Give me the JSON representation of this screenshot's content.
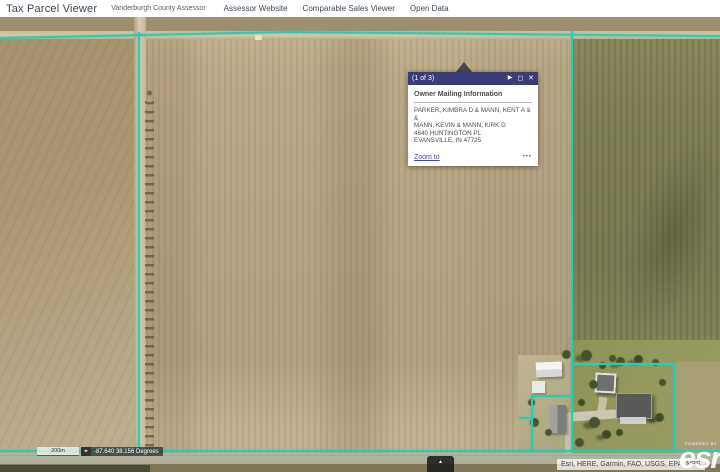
{
  "header": {
    "title": "Tax Parcel Viewer",
    "subtitle": "Vanderburgh County Assessor",
    "links": [
      "Assessor Website",
      "Comparable Sales Viewer",
      "Open Data"
    ]
  },
  "popup": {
    "pager": "(1 of 3)",
    "next_icon": "▶",
    "dock_icon": "◻",
    "close_icon": "✕",
    "title": "Owner Mailing Information",
    "owner_lines": [
      "PARKER, KIMBRA D & MANN, KENT A & &",
      "MANN, KEVIN & MANN, KIRK D",
      "4640 HUNTINGTON PL",
      "EVANSVILLE, IN 47725"
    ],
    "zoom_to_label": "Zoom to",
    "menu_icon": "•••"
  },
  "map": {
    "scale_label": "200m",
    "crosshair_icon": "⌖",
    "coordinates": "-87.640 38.156 Degrees",
    "expand_icon": "▲",
    "attribution": "Esri, HERE, Garmin, FAO, USGS, EPA, NPS",
    "powered_by": "POWERED BY",
    "esri_logo": "esri",
    "parcel_line_color": "#2fc9b2"
  }
}
